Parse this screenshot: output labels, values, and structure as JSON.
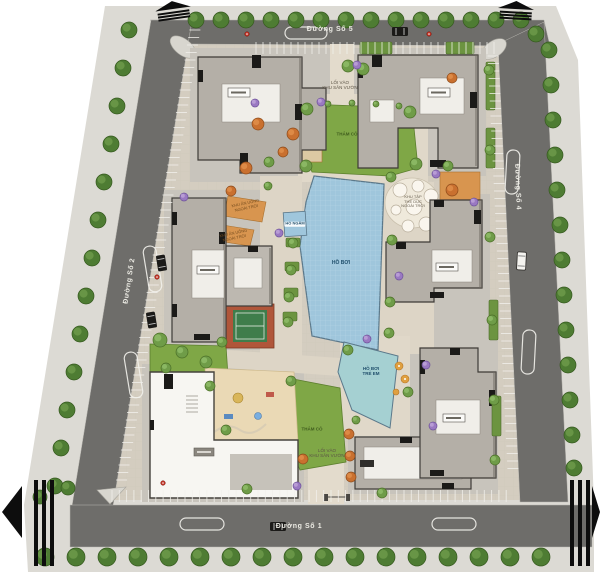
{
  "plan": {
    "streets": {
      "top": "Đường Số 5",
      "right": "Đường Số 4",
      "left": "Đường Số 2",
      "bottom": "Đường Số 1"
    },
    "labels": {
      "pool": "HỒ BƠI",
      "kids_pool_line1": "HỒ BƠI",
      "kids_pool_line2": "TRẺ EM",
      "soak_pool": "HỒ NGÂM",
      "lawn": "THẢM CỎ",
      "entrance_line1": "LỐI VÀO",
      "entrance_line2": "KHU SÂN VƯỜN",
      "dining_line1": "KHU ĂN UỐNG",
      "dining_line2": "NGOÀI TRỜI",
      "gym_line1": "KHU TẬP",
      "gym_line2": "THỂ DỤC",
      "gym_line3": "NGOÀI TRỜI"
    },
    "colors": {
      "road": "#6e6d6a",
      "sidewalk": "#dcdad4",
      "paving": "#d4cdc0",
      "apron": "#c8c4bc",
      "lawn": "#7fa746",
      "pool": "#9fc6dc",
      "kids_pool": "#a5d0d2",
      "building": "#b4afa7",
      "building_outline": "#3e3b37",
      "deck": "#d8954f",
      "white_line": "#f2f1ec",
      "accent_red": "#c03124"
    },
    "landscape": {
      "street_trees": [
        [
          196,
          20,
          8
        ],
        [
          221,
          20,
          8
        ],
        [
          246,
          20,
          8
        ],
        [
          271,
          20,
          8
        ],
        [
          296,
          20,
          8
        ],
        [
          321,
          20,
          8
        ],
        [
          346,
          20,
          8
        ],
        [
          371,
          20,
          8
        ],
        [
          396,
          20,
          8
        ],
        [
          421,
          20,
          8
        ],
        [
          446,
          20,
          8
        ],
        [
          471,
          20,
          8
        ],
        [
          496,
          20,
          8
        ],
        [
          521,
          20,
          8
        ],
        [
          536,
          34,
          8
        ],
        [
          549,
          50,
          8
        ],
        [
          551,
          85,
          8
        ],
        [
          553,
          120,
          8
        ],
        [
          555,
          155,
          8
        ],
        [
          557,
          190,
          8
        ],
        [
          560,
          225,
          8
        ],
        [
          562,
          260,
          8
        ],
        [
          564,
          295,
          8
        ],
        [
          566,
          330,
          8
        ],
        [
          568,
          365,
          8
        ],
        [
          570,
          400,
          8
        ],
        [
          572,
          435,
          8
        ],
        [
          574,
          468,
          8
        ],
        [
          129,
          30,
          8
        ],
        [
          123,
          68,
          8
        ],
        [
          117,
          106,
          8
        ],
        [
          111,
          144,
          8
        ],
        [
          104,
          182,
          8
        ],
        [
          98,
          220,
          8
        ],
        [
          92,
          258,
          8
        ],
        [
          86,
          296,
          8
        ],
        [
          80,
          334,
          8
        ],
        [
          74,
          372,
          8
        ],
        [
          67,
          410,
          8
        ],
        [
          61,
          448,
          8
        ],
        [
          55,
          486,
          8
        ],
        [
          45,
          557,
          9
        ],
        [
          76,
          557,
          9
        ],
        [
          107,
          557,
          9
        ],
        [
          138,
          557,
          9
        ],
        [
          169,
          557,
          9
        ],
        [
          200,
          557,
          9
        ],
        [
          231,
          557,
          9
        ],
        [
          262,
          557,
          9
        ],
        [
          293,
          557,
          9
        ],
        [
          324,
          557,
          9
        ],
        [
          355,
          557,
          9
        ],
        [
          386,
          557,
          9
        ],
        [
          417,
          557,
          9
        ],
        [
          448,
          557,
          9
        ],
        [
          479,
          557,
          9
        ],
        [
          510,
          557,
          9
        ],
        [
          541,
          557,
          9
        ],
        [
          40,
          497,
          7
        ],
        [
          68,
          488,
          7
        ]
      ],
      "inner_trees": [
        [
          307,
          109,
          6
        ],
        [
          410,
          112,
          6
        ],
        [
          416,
          164,
          6
        ],
        [
          306,
          166,
          6
        ],
        [
          328,
          104,
          3
        ],
        [
          352,
          103,
          3
        ],
        [
          376,
          104,
          3
        ],
        [
          399,
          106,
          3
        ],
        [
          348,
          66,
          6
        ],
        [
          363,
          69,
          6
        ],
        [
          293,
          243,
          5
        ],
        [
          291,
          270,
          5
        ],
        [
          289,
          297,
          5
        ],
        [
          288,
          322,
          5
        ],
        [
          392,
          240,
          5
        ],
        [
          390,
          302,
          5
        ],
        [
          389,
          333,
          5
        ],
        [
          160,
          340,
          7
        ],
        [
          182,
          352,
          6
        ],
        [
          206,
          362,
          6
        ],
        [
          166,
          368,
          5
        ],
        [
          222,
          342,
          5
        ],
        [
          210,
          386,
          5
        ],
        [
          226,
          430,
          5
        ],
        [
          291,
          381,
          5
        ],
        [
          348,
          350,
          5
        ],
        [
          408,
          392,
          5
        ],
        [
          391,
          177,
          5
        ],
        [
          448,
          166,
          5
        ],
        [
          489,
          70,
          5
        ],
        [
          490,
          150,
          5
        ],
        [
          490,
          237,
          5
        ],
        [
          492,
          320,
          5
        ],
        [
          494,
          400,
          5
        ],
        [
          495,
          460,
          5
        ],
        [
          382,
          493,
          5
        ],
        [
          247,
          489,
          5
        ],
        [
          356,
          420,
          4
        ],
        [
          269,
          162,
          5
        ],
        [
          268,
          186,
          4
        ]
      ],
      "orange_trees": [
        [
          258,
          124,
          6
        ],
        [
          246,
          168,
          6
        ],
        [
          231,
          191,
          5
        ],
        [
          293,
          134,
          6
        ],
        [
          283,
          152,
          5
        ],
        [
          452,
          78,
          5
        ],
        [
          452,
          190,
          6
        ],
        [
          349,
          434,
          5
        ],
        [
          350,
          456,
          5
        ],
        [
          351,
          477,
          5
        ],
        [
          303,
          459,
          5
        ]
      ],
      "purple_shrubs": [
        [
          255,
          103,
          4
        ],
        [
          321,
          102,
          4
        ],
        [
          357,
          65,
          4
        ],
        [
          436,
          174,
          4
        ],
        [
          474,
          202,
          4
        ],
        [
          399,
          276,
          4
        ],
        [
          426,
          365,
          4
        ],
        [
          433,
          426,
          4
        ],
        [
          297,
          486,
          4
        ],
        [
          184,
          197,
          4
        ],
        [
          367,
          339,
          4
        ],
        [
          279,
          233,
          4
        ]
      ],
      "hedges": [
        [
          360,
          42,
          32,
          12
        ],
        [
          446,
          42,
          28,
          12
        ],
        [
          486,
          62,
          9,
          48
        ],
        [
          486,
          128,
          9,
          40
        ],
        [
          489,
          300,
          9,
          40
        ],
        [
          492,
          396,
          9,
          40
        ],
        [
          286,
          238,
          14,
          9
        ],
        [
          285,
          262,
          14,
          9
        ],
        [
          284,
          288,
          14,
          9
        ],
        [
          283,
          312,
          14,
          9
        ]
      ]
    },
    "parking_rows": [
      {
        "o": "h",
        "a": 256,
        "b": 494,
        "base": 42,
        "step": 7,
        "len": 12
      },
      {
        "o": "h",
        "a": 112,
        "b": 508,
        "base": 490,
        "step": 7.3,
        "len": 12
      },
      {
        "o": "v",
        "a": 56,
        "b": 470,
        "base": 498,
        "yref": 44,
        "slope": 0.048,
        "dir": -1,
        "step": 7.5,
        "len": 11
      },
      {
        "o": "v",
        "a": 30,
        "b": 480,
        "base": 192,
        "yref": 14,
        "slope": -0.163,
        "dir": 1,
        "step": 7.5,
        "len": 11
      }
    ],
    "vehicles": [
      {
        "x": 392,
        "y": 27,
        "w": 16,
        "h": 9,
        "r": 0,
        "c": "dark"
      },
      {
        "x": 157,
        "y": 255,
        "w": 9,
        "h": 16,
        "r": -9,
        "c": "dark"
      },
      {
        "x": 147,
        "y": 312,
        "w": 9,
        "h": 16,
        "r": -9,
        "c": "dark"
      },
      {
        "x": 270,
        "y": 522,
        "w": 16,
        "h": 9,
        "r": 0,
        "c": "dark"
      },
      {
        "x": 517,
        "y": 252,
        "w": 9,
        "h": 18,
        "r": 3,
        "c": "white"
      }
    ],
    "hydrants": [
      [
        247,
        34
      ],
      [
        429,
        34
      ],
      [
        157,
        277
      ],
      [
        163,
        483
      ]
    ]
  },
  "icons": {
    "road_arrow": "road-continuation-arrow",
    "hydrant": "hydrant-marker",
    "car": "car-marker",
    "tree": "tree-marker"
  }
}
